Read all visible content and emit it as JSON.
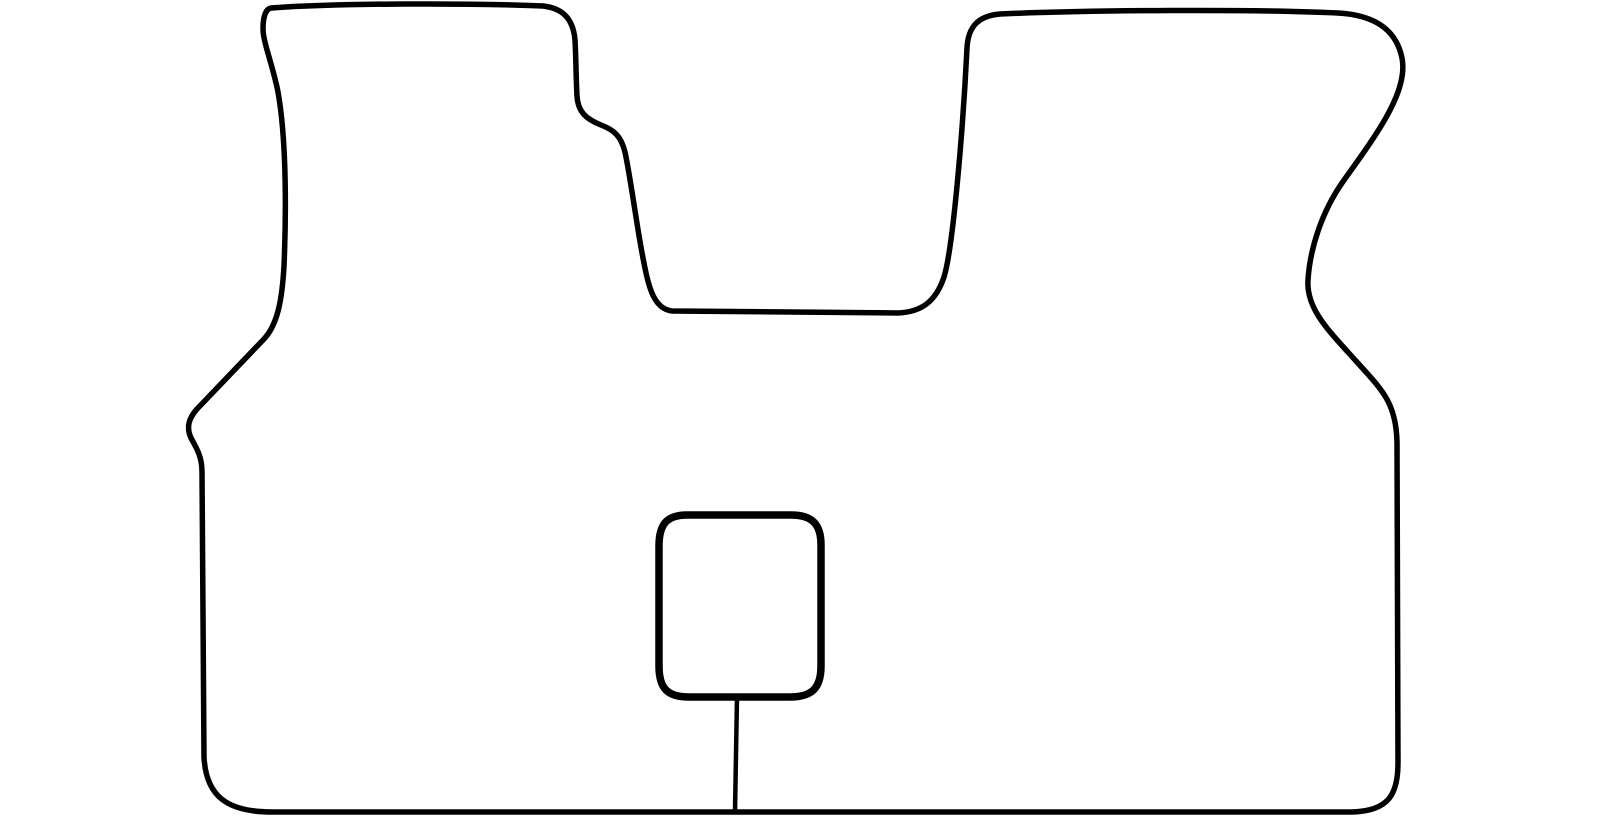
{
  "figure": {
    "description": "Black hand-drawn outline of a one-piece car floor mat template: two upper footwell lobes separated by a central transmission-tunnel notch, a small rounded-square cutout in the lower middle connected to the bottom edge by a short vertical line",
    "background_color": "#ffffff",
    "stroke_color": "#000000",
    "canvas": {
      "width": 1600,
      "height": 825
    },
    "viewbox": "0 0 1600 825",
    "stroke_widths": {
      "mat_outline": 5.5,
      "cutout_square": 7.5,
      "connector_line": 4.5
    },
    "paths": {
      "mat_outline": "M 271 8 C 340 3 470 3 543 6 C 561 8 573 17 575 40 C 576 58 576 78 577 96 C 578 112 586 119 601 125 C 614 130 621 136 625 152 C 631 180 638 235 644 263 C 649 290 655 309 672 311 L 898 313 C 922 312 936 301 944 277 C 953 248 963 130 967 48 C 968 29 976 16 1000 14 C 1090 10 1255 9 1338 13 C 1374 15 1396 29 1402 58 C 1409 93 1373 139 1342 183 C 1322 212 1310 248 1308 280 C 1306 309 1329 331 1356 361 C 1382 390 1396 402 1397 442 L 1398 763 C 1398 794 1389 811 1352 812 L 272 812 C 228 812 206 797 204 757 L 202 472 C 202 457 197 449 191 438 C 186 427 189 418 197 409 L 264 339 C 277 325 282 302 284 266 C 286 220 287 142 278 92 C 273 66 263 42 263 29 C 263 16 266 9 271 8 Z",
      "cutout_square": "M 687 515 L 791 515 C 812 515 821 524 821 545 L 821 666 C 821 688 812 697 790 697 L 689 697 C 667 697 659 688 659 666 L 659 546 C 659 524 667 515 687 515 Z",
      "connector_line": "M 737 697 L 735 812"
    }
  }
}
